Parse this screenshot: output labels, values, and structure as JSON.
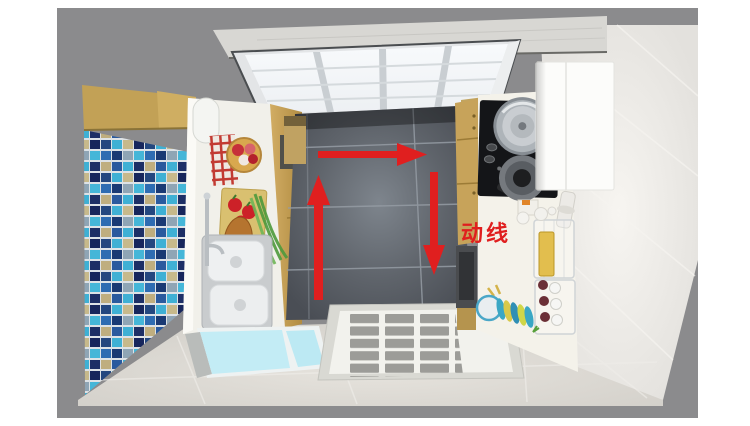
{
  "annotation": {
    "label": "动线"
  },
  "colors": {
    "accent": "#e01f1f",
    "background_gray": "#8b8b8d",
    "dark_floor": "#555a61",
    "mosaic_blue": "#2e6cb2",
    "wood_cabinet": "#c9a55d",
    "counter_white": "#f1f0ea",
    "glass_blue": "#c3ecf5"
  },
  "scene": {
    "kind": "kitchen-top-view-3d-render"
  }
}
